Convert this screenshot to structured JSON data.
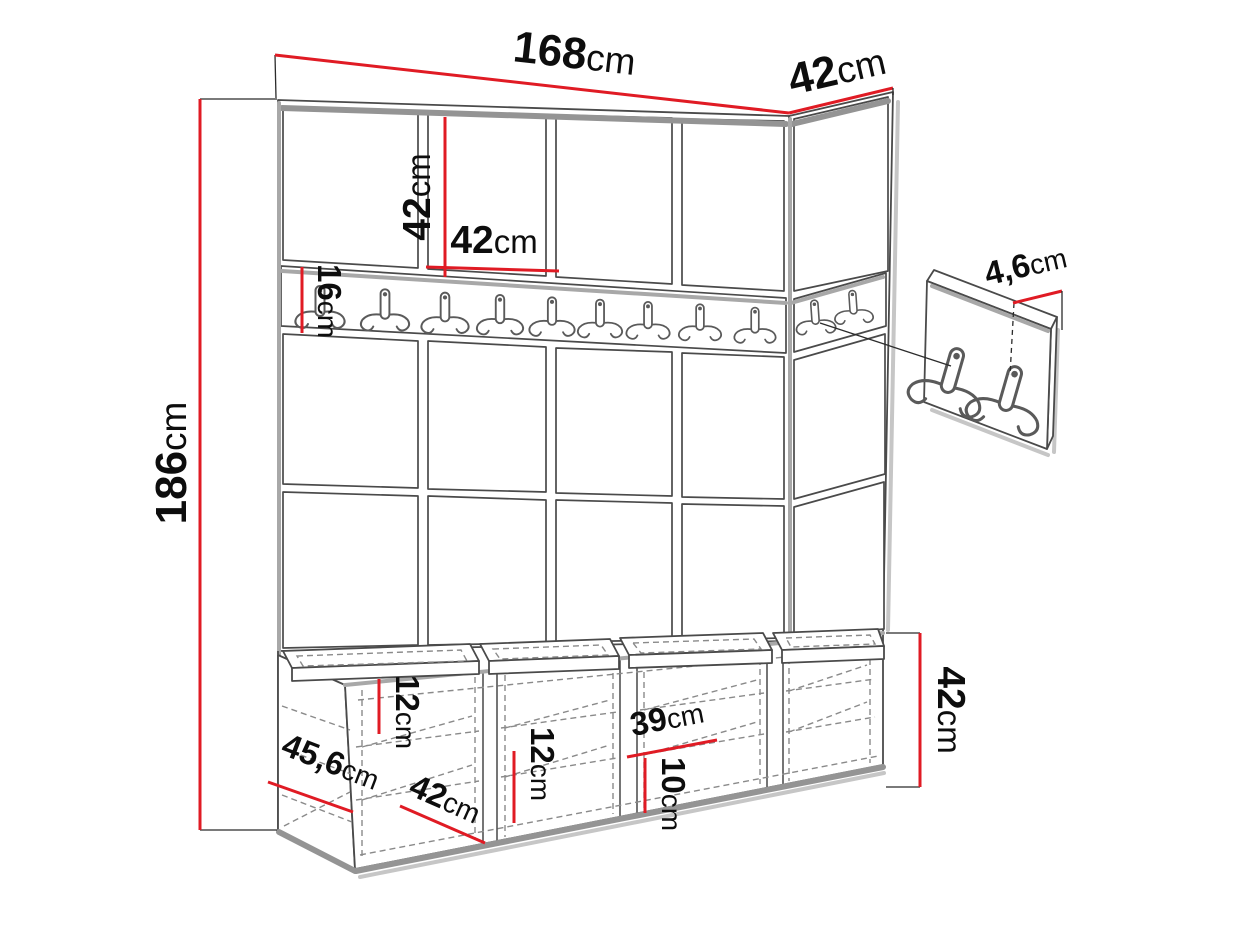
{
  "diagram": {
    "type": "furniture-dimension-drawing",
    "accent_color": "#e01b24",
    "line_color": "#4a4a4a",
    "unit_parts": [
      "paneled-wall",
      "hook-rail",
      "shoe-bench",
      "hook-panel-detail"
    ]
  },
  "dims": {
    "total_width": {
      "v": "168",
      "u": "cm"
    },
    "side_depth": {
      "v": "42",
      "u": "cm"
    },
    "panel_height": {
      "v": "42",
      "u": "cm"
    },
    "panel_width": {
      "v": "42",
      "u": "cm"
    },
    "rail_height": {
      "v": "16",
      "u": "cm"
    },
    "total_height": {
      "v": "186",
      "u": "cm"
    },
    "panel_thick": {
      "v": "4,6",
      "u": "cm"
    },
    "bench_height": {
      "v": "42",
      "u": "cm"
    },
    "shelf_gap_a": {
      "v": "12",
      "u": "cm"
    },
    "shelf_gap_b": {
      "v": "12",
      "u": "cm"
    },
    "comp_width": {
      "v": "39",
      "u": "cm"
    },
    "shelf_gap_c": {
      "v": "10",
      "u": "cm"
    },
    "bench_depth": {
      "v": "45,6",
      "u": "cm"
    },
    "bench_comp": {
      "v": "42",
      "u": "cm"
    }
  }
}
